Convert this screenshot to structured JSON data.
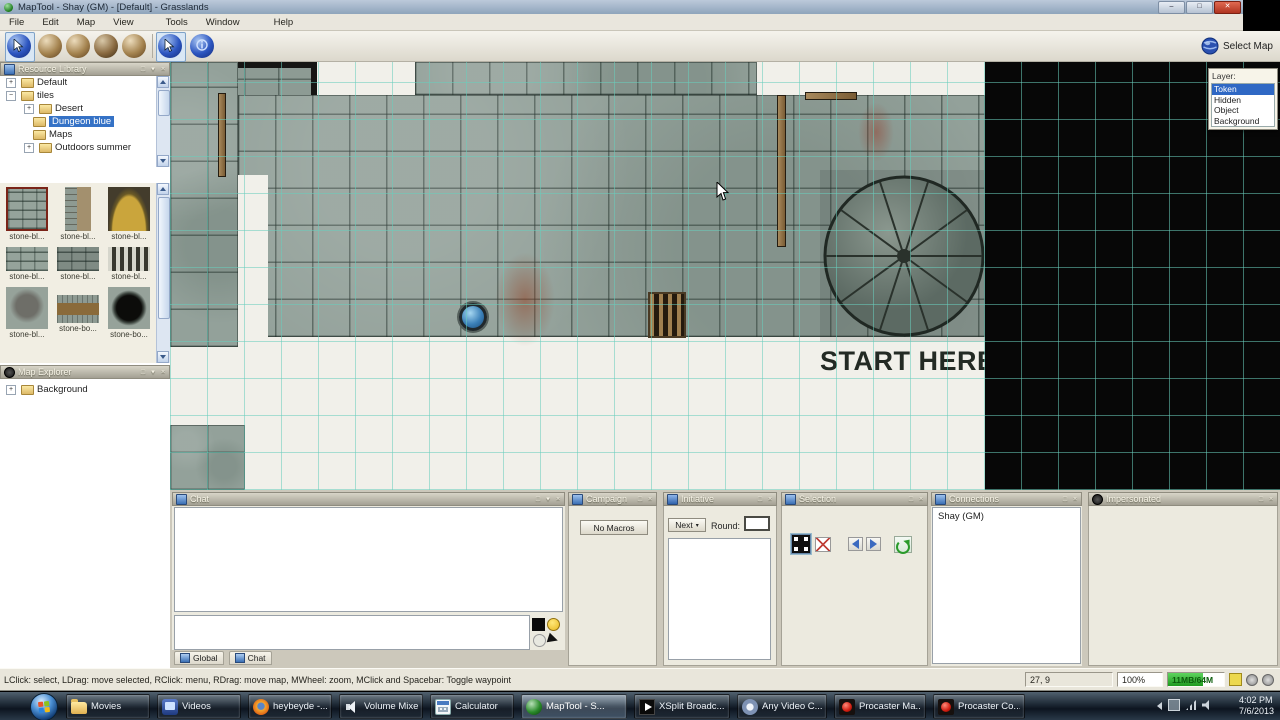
{
  "window": {
    "title": "MapTool - Shay (GM) - [Default] - Grasslands"
  },
  "menu": {
    "items": [
      "File",
      "Edit",
      "Map",
      "View",
      "Tools",
      "Window",
      "Help"
    ]
  },
  "toolbar": {
    "select_map_label": "Select Map"
  },
  "resource_library": {
    "title": "Resource Library",
    "tree": [
      {
        "label": "Default",
        "expander": "+"
      },
      {
        "label": "tiles",
        "expander": "-"
      },
      {
        "label": "Desert",
        "expander": "+"
      },
      {
        "label": "Dungeon blue",
        "selected": true
      },
      {
        "label": "Maps"
      },
      {
        "label": "Outdoors summer",
        "expander": "+"
      }
    ],
    "search_value": "",
    "thumbnails": [
      {
        "label": "stone-bl..."
      },
      {
        "label": "stone-bl..."
      },
      {
        "label": "stone-bl..."
      },
      {
        "label": "stone-bl..."
      },
      {
        "label": "stone-bl..."
      },
      {
        "label": "stone-bl..."
      },
      {
        "label": "stone-bl..."
      },
      {
        "label": "stone-bo..."
      },
      {
        "label": "stone-bo..."
      }
    ]
  },
  "map_explorer": {
    "title": "Map Explorer",
    "items": [
      {
        "label": "Background"
      }
    ]
  },
  "map": {
    "annotation": "START HERE",
    "layers_panel": {
      "label": "Layer:",
      "items": [
        "Token",
        "Hidden",
        "Object",
        "Background"
      ],
      "selected": "Token"
    }
  },
  "dock": {
    "chat": {
      "title": "Chat",
      "tabs": [
        "Global",
        "Chat"
      ],
      "input_value": ""
    },
    "campaign": {
      "title": "Campaign",
      "empty_label": "No Macros"
    },
    "initiative": {
      "title": "Initiative",
      "next_label": "Next",
      "round_label": "Round:",
      "round_value": ""
    },
    "selection": {
      "title": "Selection"
    },
    "connections": {
      "title": "Connections",
      "clients": [
        "Shay (GM)"
      ]
    },
    "impersonated": {
      "title": "Impersonated"
    }
  },
  "status_bar": {
    "hint": "LClick: select, LDrag: move selected, RClick: menu, RDrag: move map, MWheel: zoom, MClick and Spacebar: Toggle waypoint",
    "coordinates": "27, 9",
    "zoom": "100%",
    "memory": "11MB/64M"
  },
  "taskbar": {
    "buttons": [
      {
        "label": "Movies",
        "icon": "folder-icon"
      },
      {
        "label": "Videos",
        "icon": "media-player-icon"
      },
      {
        "label": "heybeyde -...",
        "icon": "firefox-icon"
      },
      {
        "label": "Volume Mixe...",
        "icon": "speaker-icon"
      },
      {
        "label": "Calculator",
        "icon": "calculator-icon"
      },
      {
        "label": "MapTool - S...",
        "icon": "maptool-globe-icon",
        "active": true
      },
      {
        "label": "XSplit Broadc...",
        "icon": "play-icon"
      },
      {
        "label": "Any Video C...",
        "icon": "video-converter-icon"
      },
      {
        "label": "Procaster Ma...",
        "icon": "procaster-icon"
      },
      {
        "label": "Procaster Co...",
        "icon": "procaster-icon"
      }
    ],
    "clock": {
      "time": "4:02 PM",
      "date": "7/6/2013"
    }
  },
  "colors": {
    "grid_teal": "#69cdbc",
    "selection_blue": "#3572c6",
    "memory_green": "#1f9a1f",
    "thumbnail_selected_border": "#7a2418"
  }
}
